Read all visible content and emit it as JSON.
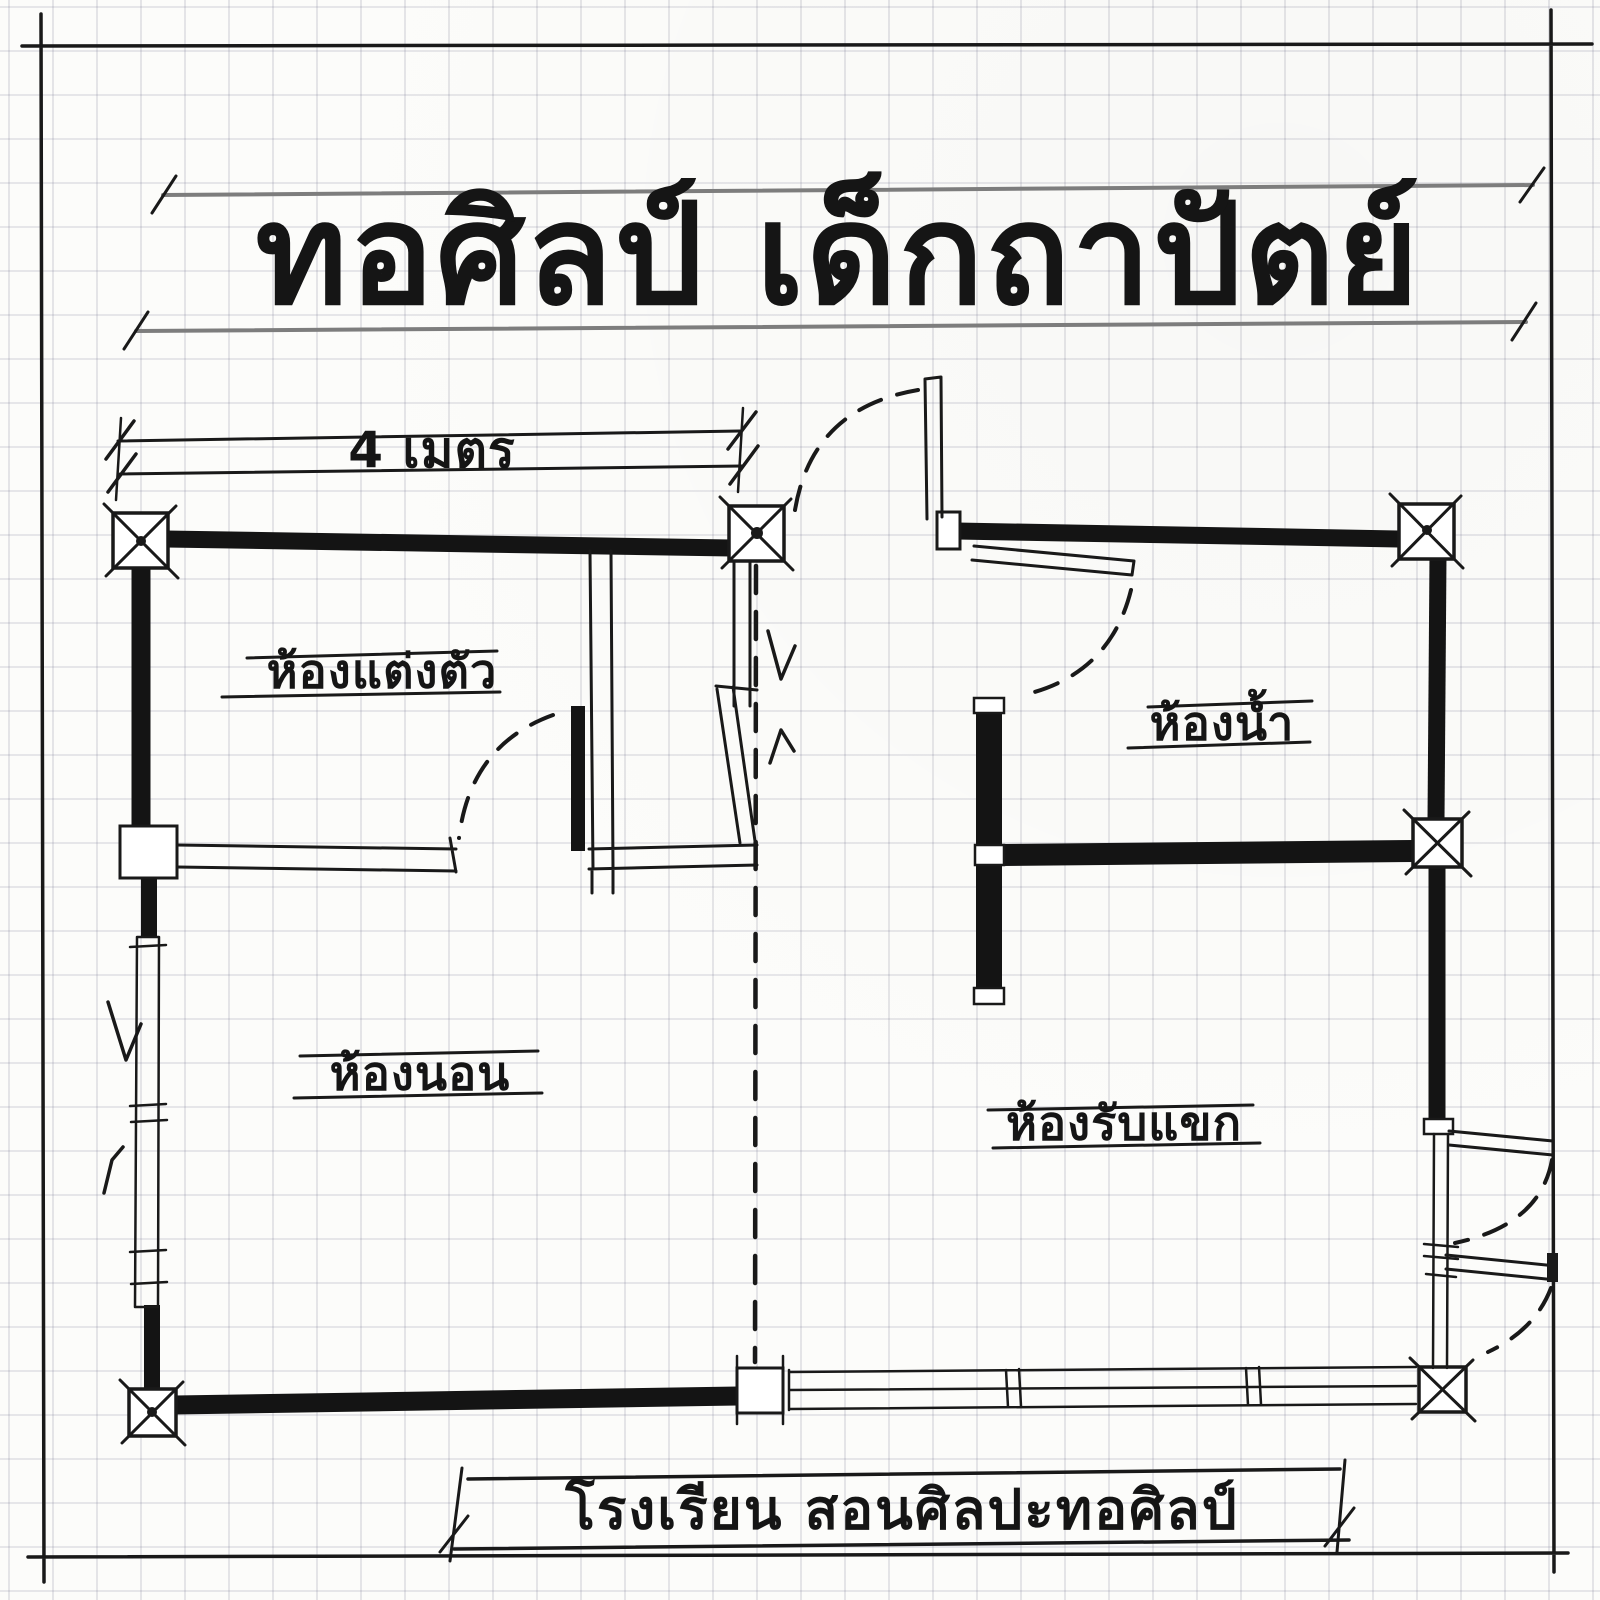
{
  "page": {
    "title": "ทอศิลป์ เด็กถาปัตย์",
    "paper_color": "#fcfcfa",
    "grid_color": "#e1e1e7",
    "ink_color": "#191919",
    "guide_color": "#7d7d7d"
  },
  "plan": {
    "dimension_label": "4 เมตร",
    "rooms": [
      {
        "id": "dressing-room",
        "label": "ห้องแต่งตัว"
      },
      {
        "id": "bathroom",
        "label": "ห้องน้ำ"
      },
      {
        "id": "bedroom",
        "label": "ห้องนอน"
      },
      {
        "id": "living-room",
        "label": "ห้องรับแขก"
      }
    ],
    "caption": "โรงเรียน สอนศิลปะทอศิลป์"
  }
}
